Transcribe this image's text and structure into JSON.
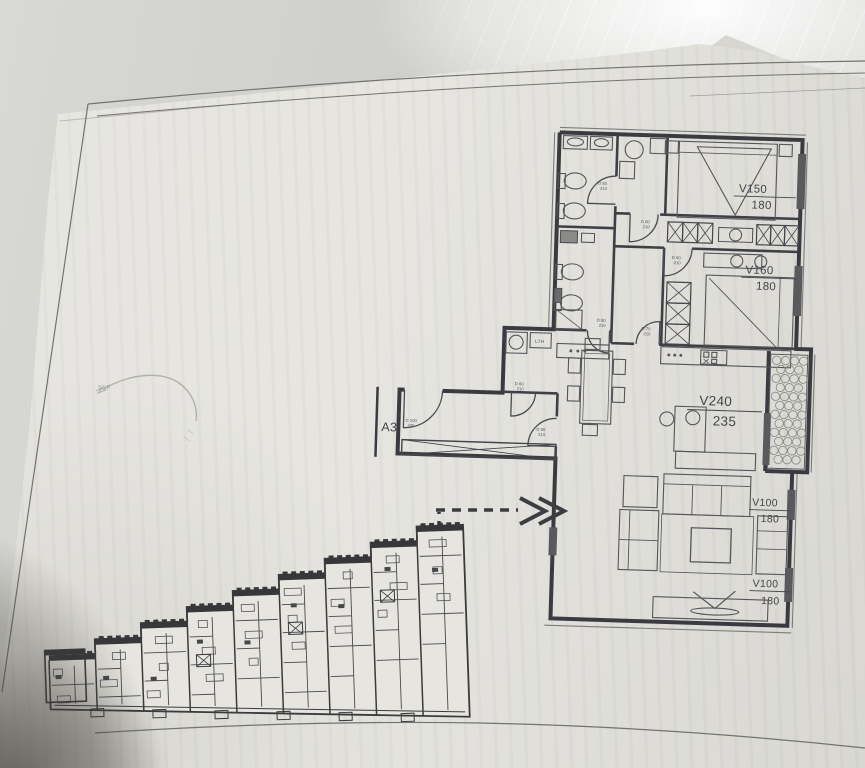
{
  "palette": {
    "ink": "#3a3a41",
    "ink_soft": "#6a6a68",
    "paper": "#e3e2dd",
    "desk": "#cfd0cc",
    "shadow": "#4e4c46"
  },
  "plan": {
    "unit_label": "A3",
    "laundry_label": "LTH",
    "pencil_note": "55F",
    "window_tags": {
      "bedroom1": {
        "code": "V150",
        "size": "180"
      },
      "bedroom2": {
        "code": "V160",
        "size": "180"
      },
      "terrace": {
        "code": "V240",
        "size": "235"
      },
      "living_upper": {
        "code": "V100",
        "size": "180"
      },
      "living_lower": {
        "code": "V100",
        "size": "180"
      }
    },
    "door_tags": [
      {
        "code": "D 80",
        "size": "210"
      },
      {
        "code": "D 80",
        "size": "210"
      },
      {
        "code": "D 90",
        "size": "210"
      },
      {
        "code": "D 80",
        "size": "210"
      },
      {
        "code": "D 70",
        "size": "210"
      },
      {
        "code": "D 60",
        "size": "210"
      },
      {
        "code": "D 100",
        "size": "230"
      },
      {
        "code": "D 90",
        "size": "210"
      }
    ]
  }
}
